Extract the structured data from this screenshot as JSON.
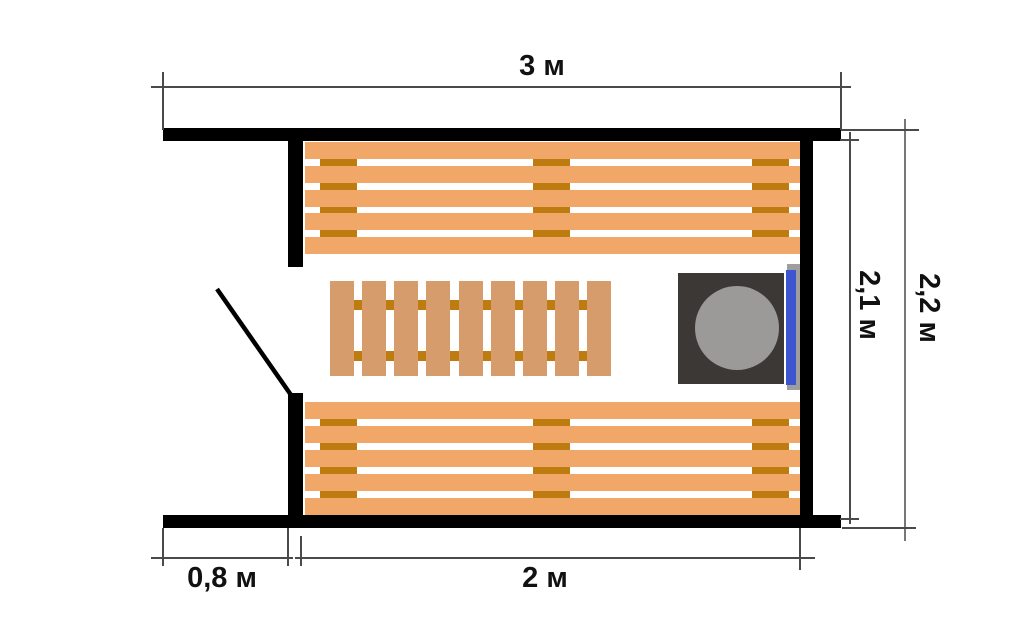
{
  "meta": {
    "type": "floor-plan",
    "subject": "Sauna layout plan with benches, floor grate, stove and door swing"
  },
  "dimensions": {
    "overall_width": "3 м",
    "room_inner_depth": "2,1 м",
    "overall_depth": "2,2 м",
    "porch_width": "0,8 м",
    "room_width": "2 м"
  },
  "objects": {
    "top_bench": {
      "label": "upper bench",
      "planks": 5,
      "batten_columns": 3
    },
    "bottom_bench": {
      "label": "lower bench",
      "planks": 5,
      "batten_columns": 3
    },
    "floor_grate": {
      "label": "floor grate",
      "planks": 9,
      "batten_rows": 2
    },
    "stove": {
      "label": "stove with round lid"
    },
    "heater": {
      "label": "wall-mounted heater element"
    },
    "door": {
      "label": "door swing line"
    }
  },
  "colors": {
    "background": "#FFFFFF",
    "wall": "#000000",
    "bench-plank": "#F0A768",
    "grate-plank": "#D79C6C",
    "batten": "#BE7B10",
    "stove-body": "#3B3836",
    "stove-lid": "#9C9A98",
    "heater-blue": "#3D55CE",
    "heater-plate": "#9E9E9E",
    "dim-line": "#4A4A4A",
    "dim-line-light": "#777777"
  }
}
